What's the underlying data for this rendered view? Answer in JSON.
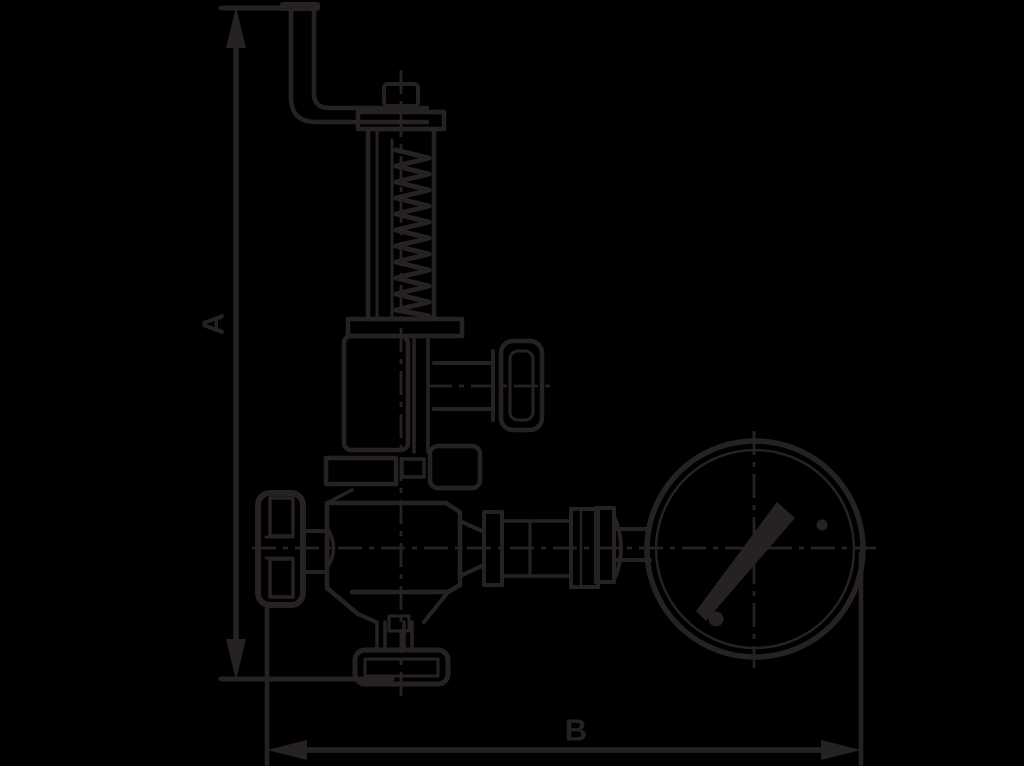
{
  "diagram": {
    "background_color": "#000000",
    "line_color": "#262223",
    "dimensions": [
      {
        "label": "A",
        "axis": "vertical"
      },
      {
        "label": "B",
        "axis": "horizontal"
      }
    ]
  }
}
